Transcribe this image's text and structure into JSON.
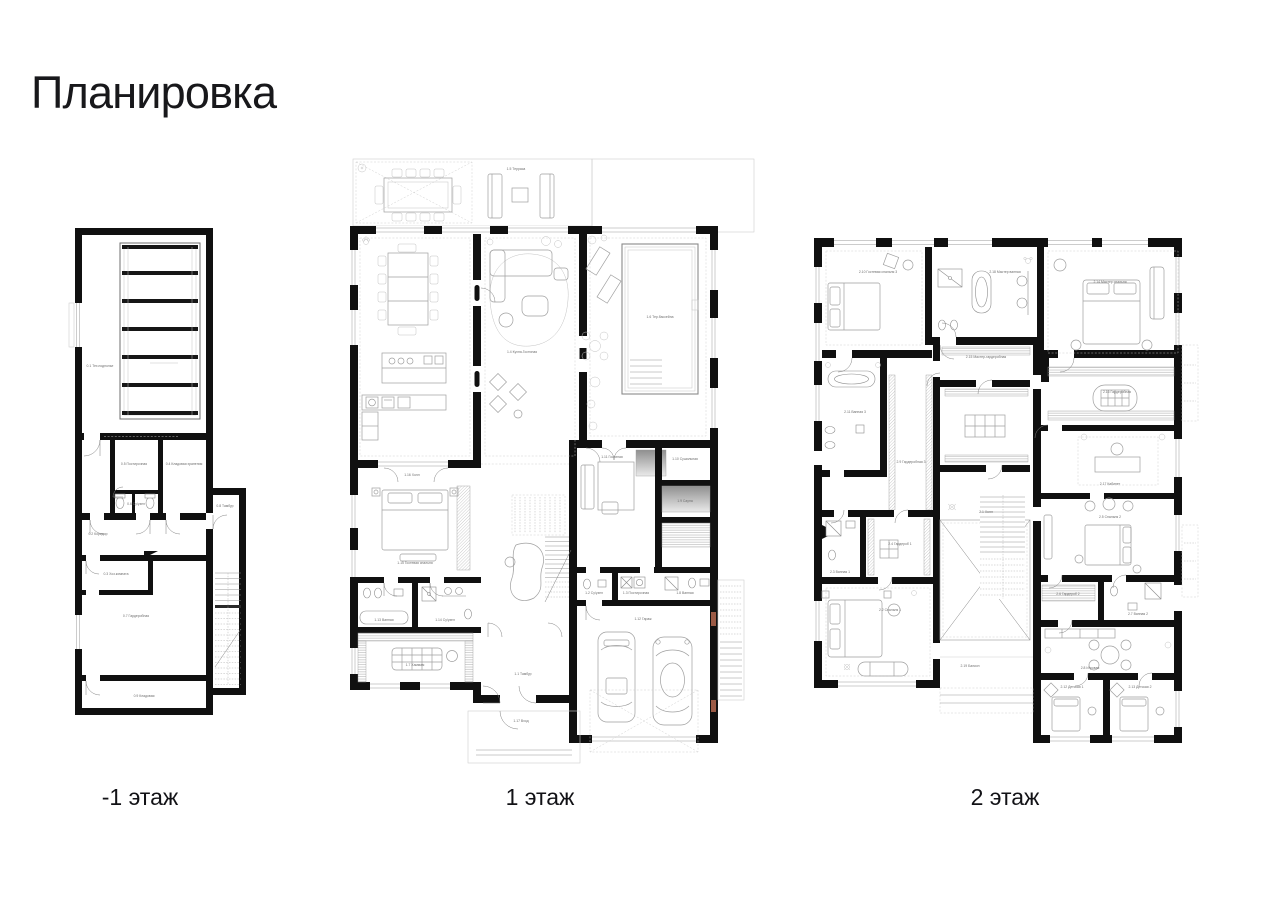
{
  "page": {
    "title": "Планировка"
  },
  "palette": {
    "walls": "#101010",
    "furniture": "#9f9f9f",
    "labels": "#6f6f6f",
    "paper": "#ffffff",
    "wood_accent": "#9b5a45"
  },
  "floors": [
    {
      "id": "floor-minus-1",
      "caption": "-1 этаж",
      "rooms": [
        {
          "x": 40,
          "y": 152,
          "label": "0.1 Тех.подполье"
        },
        {
          "x": 74,
          "y": 250,
          "label": "0.5 Постирочная"
        },
        {
          "x": 124,
          "y": 250,
          "label": "0.4 Кладовая хранения"
        },
        {
          "x": 76,
          "y": 290,
          "label": "0.6 Су/узел"
        },
        {
          "x": 38,
          "y": 320,
          "label": "0.2 Коридор"
        },
        {
          "x": 165,
          "y": 292,
          "label": "0.8 Тамбур"
        },
        {
          "x": 56,
          "y": 360,
          "label": "0.3 Хоз.комната"
        },
        {
          "x": 76,
          "y": 402,
          "label": "0.7 Гардеробная"
        },
        {
          "x": 84,
          "y": 482,
          "label": "0.9 Кладовая"
        }
      ]
    },
    {
      "id": "floor-1",
      "caption": "1 этаж",
      "rooms": [
        {
          "x": 176,
          "y": 20,
          "label": "1.5 Терраса"
        },
        {
          "x": 182,
          "y": 203,
          "label": "1.4 Кухня-Гостиная"
        },
        {
          "x": 320,
          "y": 168,
          "label": "1.6 Тер.бассейна"
        },
        {
          "x": 72,
          "y": 326,
          "label": "1.16 Холл"
        },
        {
          "x": 75,
          "y": 414,
          "label": "1.15 Гостевая спальня"
        },
        {
          "x": 44,
          "y": 471,
          "label": "1.13 Ванная"
        },
        {
          "x": 105,
          "y": 471,
          "label": "1.14 Су/узел"
        },
        {
          "x": 75,
          "y": 516,
          "label": "1.7 Хаммам"
        },
        {
          "x": 272,
          "y": 308,
          "label": "1.11 Гостиная"
        },
        {
          "x": 345,
          "y": 310,
          "label": "1.10 Сушильная"
        },
        {
          "x": 345,
          "y": 352,
          "label": "1.9 Сауна"
        },
        {
          "x": 254,
          "y": 444,
          "label": "1.2 Су/узел"
        },
        {
          "x": 296,
          "y": 444,
          "label": "1.3 Постирочная"
        },
        {
          "x": 345,
          "y": 444,
          "label": "1.8 Ванная"
        },
        {
          "x": 303,
          "y": 470,
          "label": "1.12 Гараж"
        },
        {
          "x": 183,
          "y": 525,
          "label": "1.1 Тамбур"
        },
        {
          "x": 181,
          "y": 572,
          "label": "1.17 Вход"
        }
      ]
    },
    {
      "id": "floor-2",
      "caption": "2 этаж",
      "rooms": [
        {
          "x": 88,
          "y": 48,
          "label": "2.10 Гостевая спальня 3"
        },
        {
          "x": 215,
          "y": 48,
          "label": "2.18 Мастер ванная"
        },
        {
          "x": 320,
          "y": 58,
          "label": "2.14 Мастер спальня"
        },
        {
          "x": 65,
          "y": 188,
          "label": "2.11 Ванная 3"
        },
        {
          "x": 121,
          "y": 238,
          "label": "2.9 Гардеробная 3"
        },
        {
          "x": 196,
          "y": 133,
          "label": "2.15 Мастер-гардеробная"
        },
        {
          "x": 327,
          "y": 168,
          "label": "2.16 Гардеробная"
        },
        {
          "x": 320,
          "y": 260,
          "label": "2.17 Кабинет"
        },
        {
          "x": 196,
          "y": 288,
          "label": "2.1 Холл"
        },
        {
          "x": 320,
          "y": 293,
          "label": "2.5 Спальня 2"
        },
        {
          "x": 278,
          "y": 370,
          "label": "2.6 Гардероб 2"
        },
        {
          "x": 348,
          "y": 390,
          "label": "2.7 Ванная 2"
        },
        {
          "x": 50,
          "y": 348,
          "label": "2.3 Ванная 1"
        },
        {
          "x": 110,
          "y": 320,
          "label": "2.4 Гардероб 1"
        },
        {
          "x": 100,
          "y": 386,
          "label": "2.2 Спальня 1"
        },
        {
          "x": 300,
          "y": 444,
          "label": "2.8 Игровая"
        },
        {
          "x": 282,
          "y": 463,
          "label": "2.12 Детская 1"
        },
        {
          "x": 350,
          "y": 463,
          "label": "2.13 Детская 2"
        },
        {
          "x": 180,
          "y": 442,
          "label": "2.19 Балкон"
        }
      ]
    }
  ]
}
